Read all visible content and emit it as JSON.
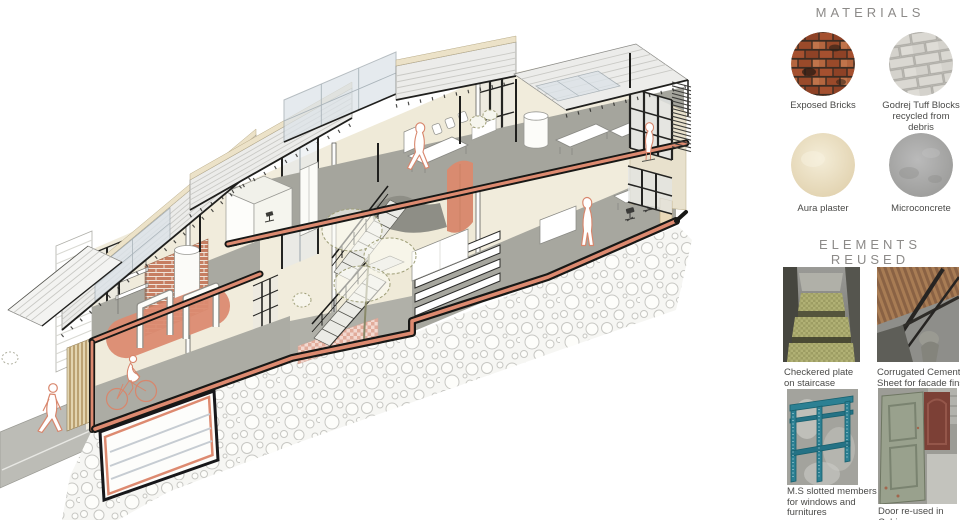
{
  "panel": {
    "materials": {
      "title": "MATERIALS",
      "items": [
        {
          "name": "exposed-bricks",
          "label": "Exposed Bricks"
        },
        {
          "name": "godrej-tuff-blocks",
          "label": "Godrej Tuff Blocks\nrecycled from debris"
        },
        {
          "name": "aura-plaster",
          "label": "Aura plaster"
        },
        {
          "name": "microconcrete",
          "label": "Microconcrete"
        }
      ]
    },
    "elements_reused": {
      "title": "ELEMENTS REUSED",
      "items": [
        {
          "name": "checkered-plate",
          "label": "Checkered plate\non staircase"
        },
        {
          "name": "corrugated-cement-sheet",
          "label": "Corrugated Cement\nSheet for facade fins"
        },
        {
          "name": "ms-slotted-members",
          "label": "M.S slotted members\nfor windows and\nfurnitures"
        },
        {
          "name": "door-reused",
          "label": "Door re-used in Cabin"
        }
      ]
    }
  },
  "illustration": {
    "description": "Axonometric cutaway section of a two-storey adaptive-reuse office building on a sloping rubble plinth, with corrugated roofs and skylights, central steel stair with tree atrium, curved terracotta partitions, stepped seating and human figures",
    "colors": {
      "accent_terracotta": "#db8b71",
      "brick": "#c67e62",
      "wall_cream": "#f0ebdb",
      "floor_concrete": "#a5a59d",
      "roof_grey": "#ececea",
      "skylight_glass": "#dce3e8",
      "timber_slats": "#bba272",
      "figure_outline": "#d8866c",
      "mullion_black": "#242422"
    }
  }
}
